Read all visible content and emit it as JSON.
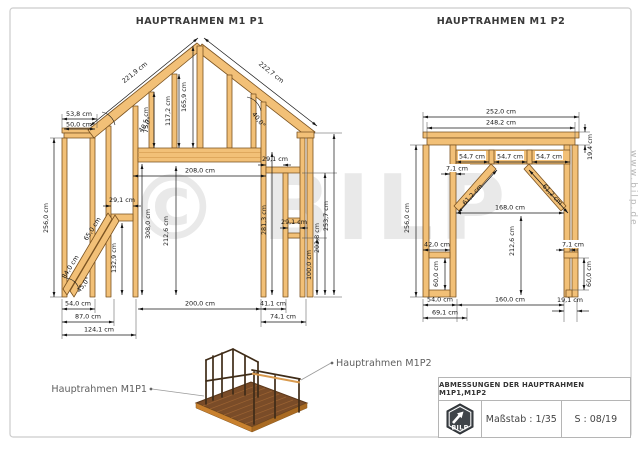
{
  "frame1": {
    "title": "HAUPTRAHMEN M1 P1",
    "dims": {
      "plate_outer": "53,8 cm",
      "plate_inner": "50,0 cm",
      "rafter_left": "221,9 cm",
      "rafter_right": "222,7 cm",
      "roof_angle_left": "40,0°",
      "roof_angle_right": "40,0°",
      "roof_stud_short": "75,5 cm",
      "roof_stud_mid": "117,2 cm",
      "roof_stud_ridge": "165,9 cm",
      "beam_gap": "29,1 cm",
      "loft_span": "208,0 cm",
      "wall_left_height": "256,0 cm",
      "inner_height": "308,0 cm",
      "opening_height": "212,6 cm",
      "left_gap": "29,1 cm",
      "left_stud_height": "132,9 cm",
      "brace_long": "84,0 cm",
      "brace_short": "65,0 cm",
      "brace_angle": "45,0°",
      "right_stud_height": "281,3 cm",
      "window_gap": "29,1 cm",
      "sill_height": "100,0 cm",
      "ledger_height": "202,8 cm",
      "wall_right_height": "253,7 cm",
      "base_left_a": "54,0 cm",
      "base_left_b": "87,0 cm",
      "base_left_c": "124,1 cm",
      "base_span": "200,0 cm",
      "base_right_a": "41,1 cm",
      "base_right_b": "74,1 cm"
    }
  },
  "frame2": {
    "title": "HAUPTRAHMEN M1 P2",
    "dims": {
      "top_outer": "252,0 cm",
      "top_inner": "248,2 cm",
      "beam_depth": "19,4 cm",
      "header_seg_1": "54,7 cm",
      "header_seg_2": "54,7 cm",
      "header_seg_3": "54,7 cm",
      "stud_left": "7,1 cm",
      "stud_right": "7,1 cm",
      "brace_left": "61,2 cm",
      "brace_right": "61,2 cm",
      "wall_height": "256,0 cm",
      "shelf_width": "42,0 cm",
      "shelf_drop_left": "60,0 cm",
      "shelf_drop_right": "60,0 cm",
      "opening_width": "168,0 cm",
      "opening_height": "212,6 cm",
      "base_left_a": "54,0 cm",
      "base_left_b": "69,1 cm",
      "base_span": "160,0 cm",
      "base_right": "19,1 cm"
    }
  },
  "overview": {
    "label_m1p1": "Hauptrahmen M1P1",
    "label_m1p2": "Hauptrahmen M1P2"
  },
  "titleblock": {
    "title": "ABMESSUNGEN DER HAUPTRAHMEN M1P1,M1P2",
    "scale": "Maßstab : 1/35",
    "sheet": "S : 08/19",
    "logo": "BILP"
  },
  "watermark": {
    "text": "© BILP",
    "site": "www.bilp.de"
  },
  "colors": {
    "wood": "#F2C077",
    "wood_stroke": "#7A5220",
    "dim_line": "#141414",
    "page_border": "#cccccc",
    "logo_bg": "#3F4449"
  }
}
